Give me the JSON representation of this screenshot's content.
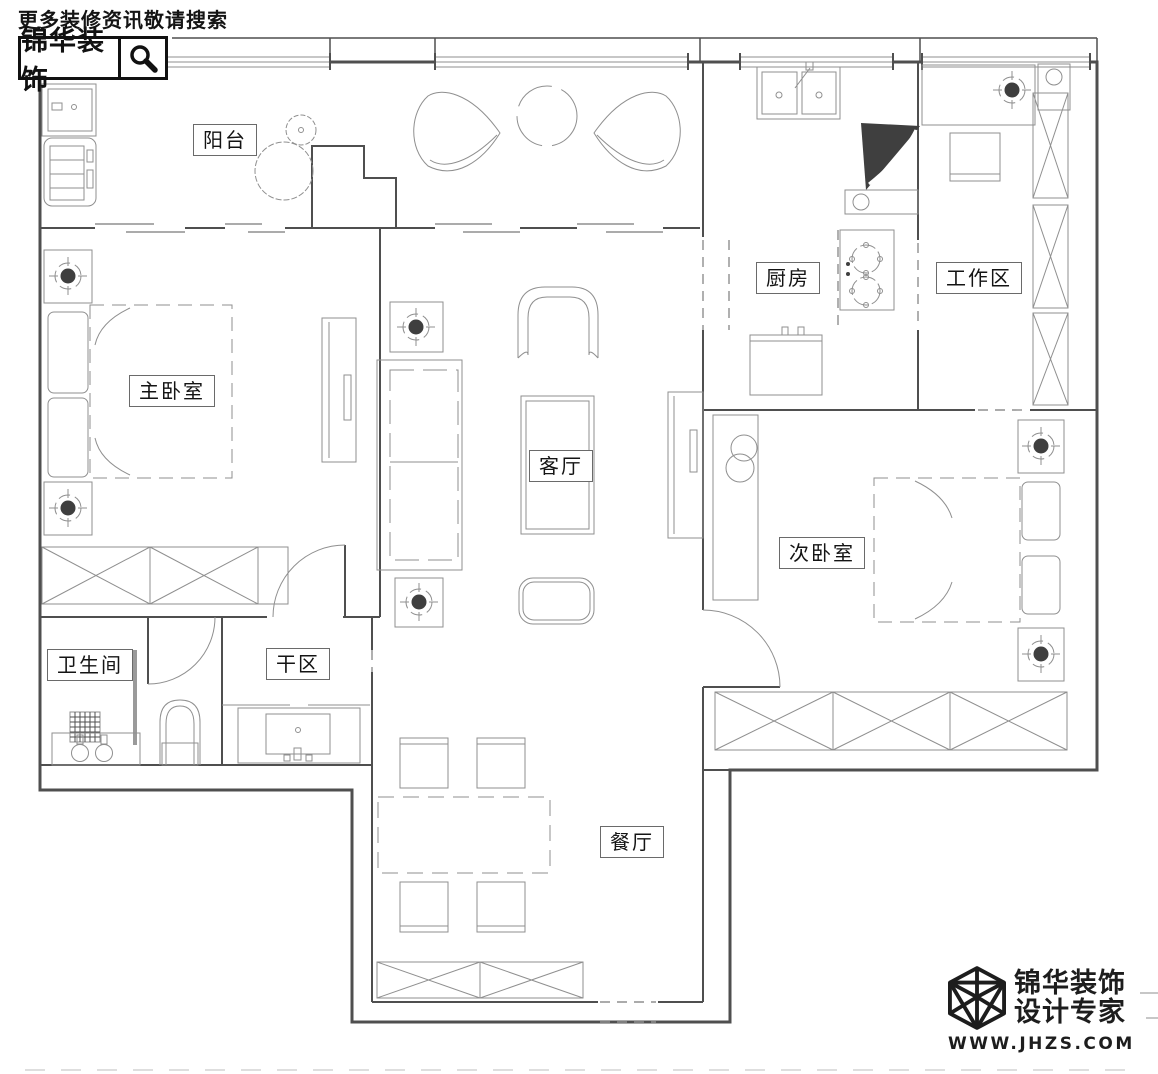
{
  "header": {
    "tagline": "更多装修资讯敬请搜索",
    "brand": "锦华装饰"
  },
  "rooms": {
    "balcony": {
      "label": "阳台"
    },
    "master_bedroom": {
      "label": "主卧室"
    },
    "living_room": {
      "label": "客厅"
    },
    "kitchen": {
      "label": "厨房"
    },
    "work_area": {
      "label": "工作区"
    },
    "second_bedroom": {
      "label": "次卧室"
    },
    "bathroom": {
      "label": "卫生间"
    },
    "dry_area": {
      "label": "干区"
    },
    "dining_room": {
      "label": "餐厅"
    }
  },
  "footer": {
    "brand": "锦华装饰",
    "subtitle": "设计专家",
    "website": "WWW.JHZS.COM"
  },
  "icons": {
    "search": "magnifier-icon",
    "logo": "cube-wireframe-icon"
  },
  "colors": {
    "wall": "#4f4f4f",
    "furn": "#8f8f8f",
    "ink": "#141414",
    "dark": "#3f3f3f",
    "paper": "#ffffff"
  }
}
